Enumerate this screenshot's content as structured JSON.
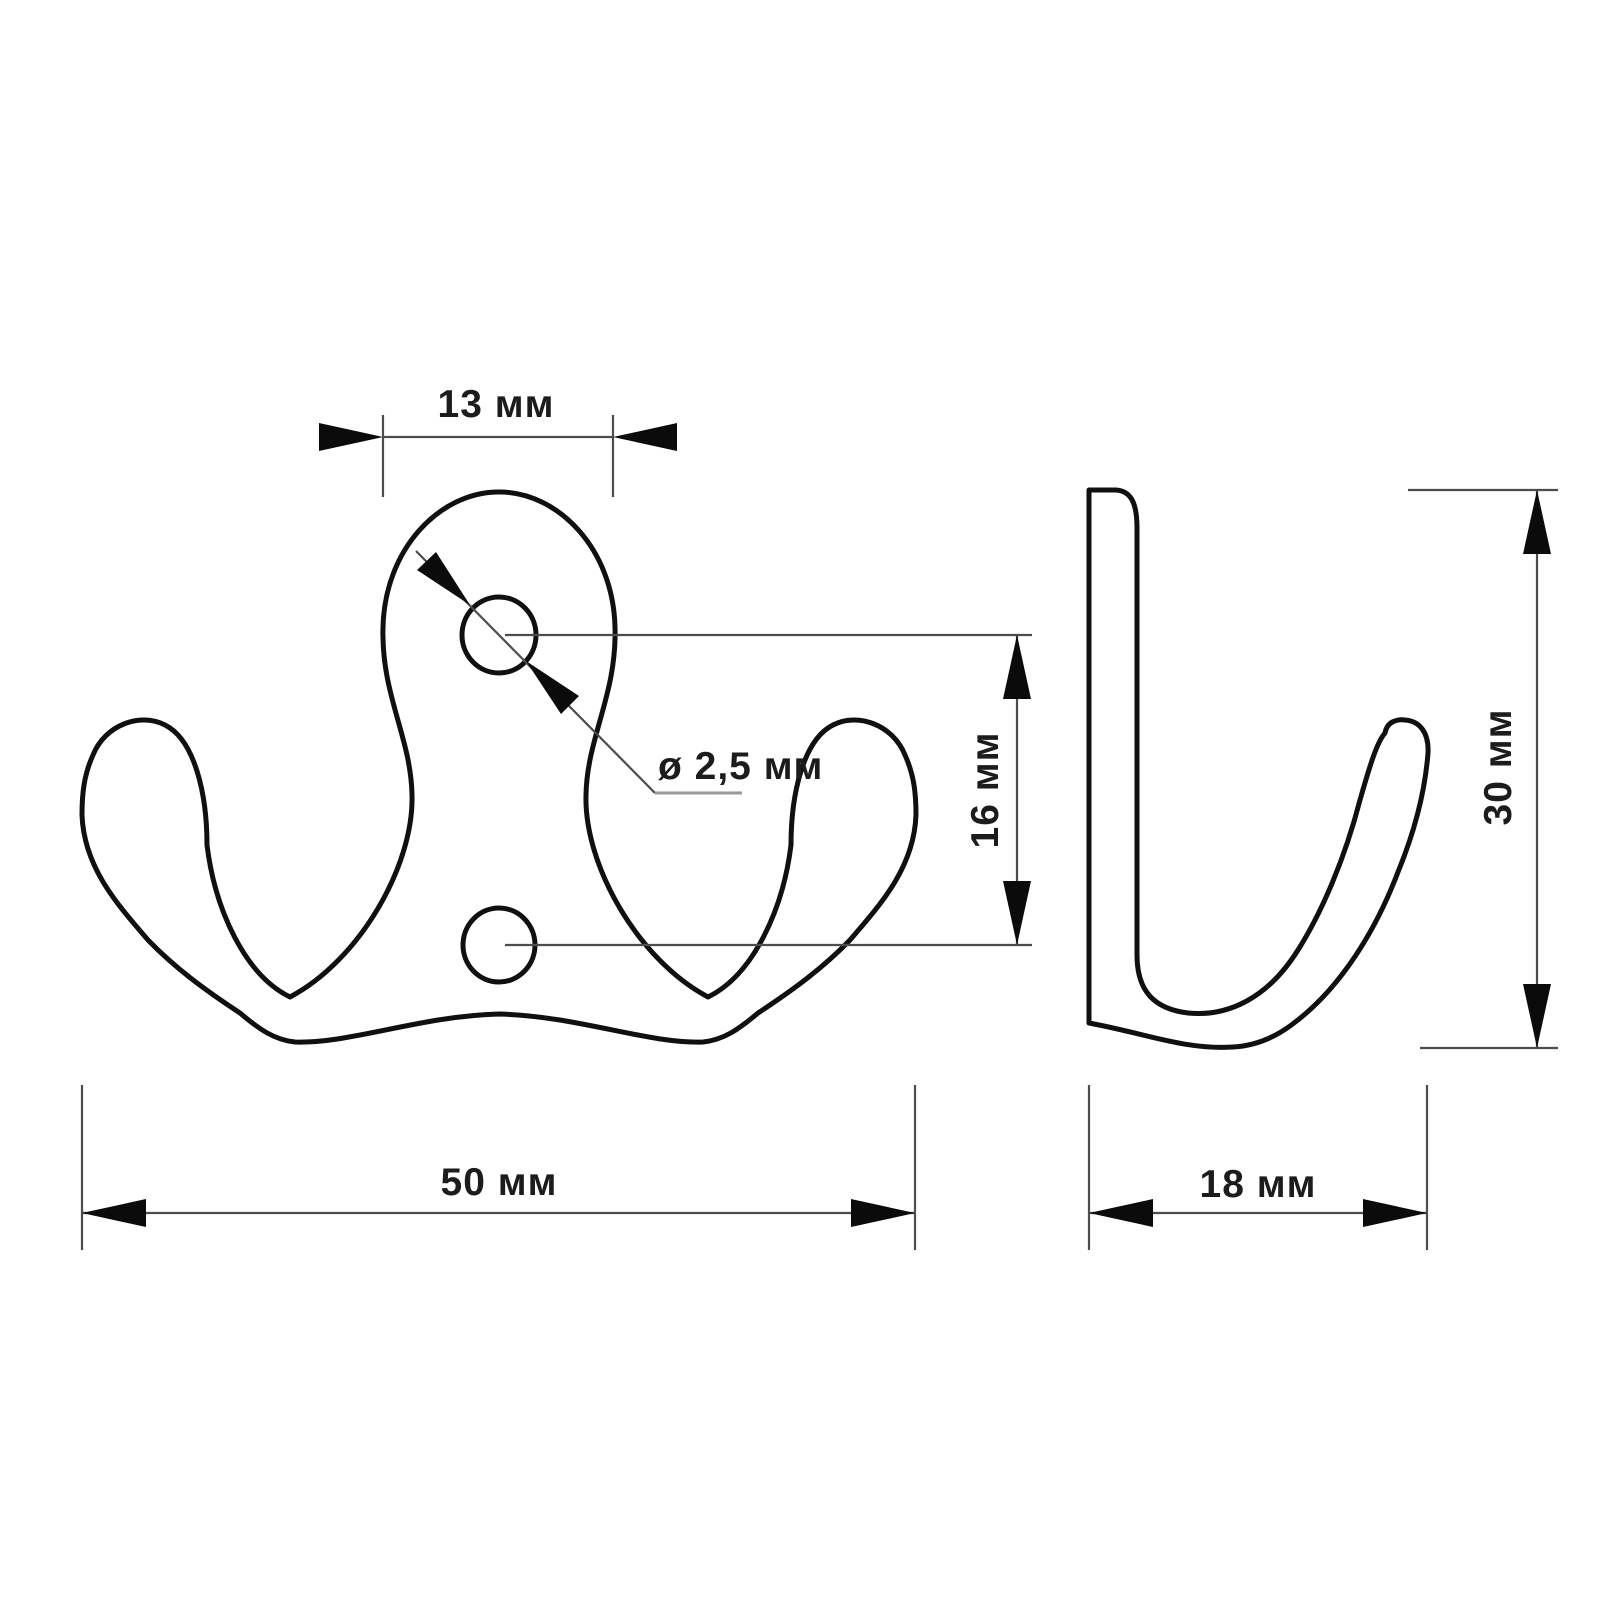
{
  "drawing": {
    "kind": "technical-drawing",
    "subject": "double hook with mounting plate, two views with dimensions",
    "units_label": "мм",
    "background": "#ffffff",
    "colors": {
      "outline": "#101010",
      "dimension_line": "#4d4d4d",
      "leader_shelf": "#9a9a9a",
      "arrow": "#0b0b0b",
      "label_text": "#1c1c1c"
    },
    "views": {
      "front": {
        "id": "front-view",
        "hole_count": 2
      },
      "side": {
        "id": "side-view"
      }
    },
    "dimensions": {
      "top_width": {
        "label": "13 мм",
        "value": 13,
        "orientation": "horizontal",
        "view": "front"
      },
      "hole_diameter": {
        "label": "ø 2,5 мм",
        "value": 2.5,
        "orientation": "leader",
        "view": "front"
      },
      "hole_spacing": {
        "label": "16 мм",
        "value": 16,
        "orientation": "vertical",
        "view": "front"
      },
      "total_width": {
        "label": "50 мм",
        "value": 50,
        "orientation": "horizontal",
        "view": "front"
      },
      "height": {
        "label": "30 мм",
        "value": 30,
        "orientation": "vertical",
        "view": "side"
      },
      "depth": {
        "label": "18 мм",
        "value": 18,
        "orientation": "horizontal",
        "view": "side"
      }
    }
  }
}
